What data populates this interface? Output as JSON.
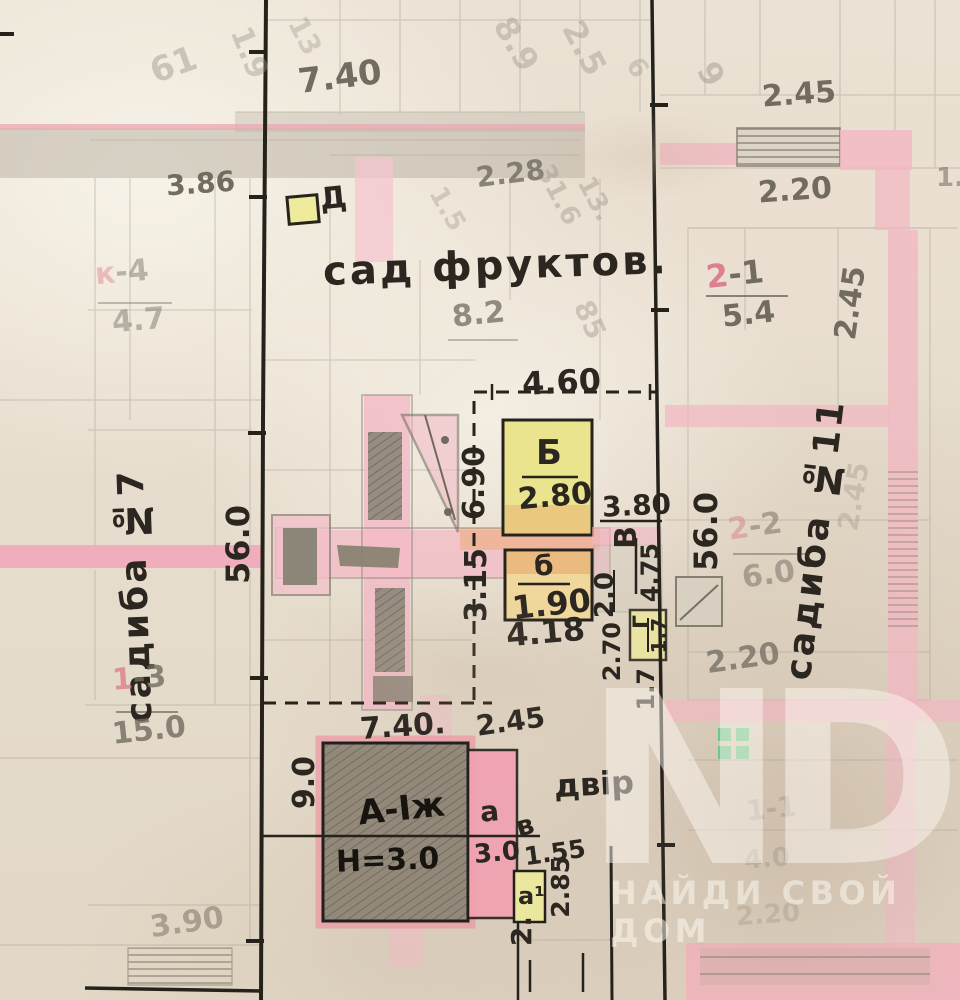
{
  "labels": {
    "orchard": "сад фруктов.",
    "yard": "двір",
    "marker_d": "Д",
    "estate_left": "садиба №7",
    "estate_right": "садиба №11",
    "frontage_left": "56.0",
    "frontage_right": "56.0",
    "bldg_b_letter": "Б",
    "bldg_b_area": "2.80",
    "bldg_b2_letter": "б",
    "bldg_b2_area": "1.90",
    "bldg_v_letter": "В",
    "bldg_v_area": "4.75",
    "bldg_g_letter": "Г",
    "bldg_g_area": "1.7",
    "bldg_a_letter": "А-Іж",
    "bldg_a_height": "Н=3.0",
    "annex_a_letter": "а",
    "annex_a_area": "3.0",
    "annex_a1_letter": "а¹",
    "letter_v_small": "в",
    "apt21_num": "2",
    "apt21_idx": "-1",
    "apt21_area": "5.4",
    "apt22_num": "2",
    "apt22_idx": "-2",
    "apt22_area": "6.0",
    "apt13_num": "1",
    "apt13_idx": "-3",
    "apt13_area": "15.0",
    "aptk4_num": "к",
    "aptk4_idx": "-4",
    "aptk4_area": "4.7",
    "dim_740_top": "7.40",
    "dim_386": "3.86",
    "dim_228": "2.28",
    "dim_82": "8.2",
    "dim_460": "4.60",
    "dim_690": "6.90",
    "dim_315": "3.15",
    "dim_380": "3.80",
    "dim_20": "2.0",
    "dim_418": "4.18",
    "dim_270": "2.70",
    "dim_17": "1.7",
    "dim_740_bottom": "7.40.",
    "dim_245_bottom": "2.45",
    "dim_90": "9.0",
    "dim_155": "1.55",
    "dim_285": "2.85",
    "dim_2dot": "2.",
    "dim_390": "3.90",
    "dim_245_topright": "2.45",
    "dim_220_topright": "2.20",
    "dim_245_right": "2.45",
    "dim_220_right": "2.20",
    "dim_245_right2": "2.45",
    "faint_61": "61",
    "faint_19": "1.9",
    "faint_13": "13",
    "faint_89": "8.9",
    "faint_25": "2.5",
    "faint_6": "6",
    "faint_9": "9",
    "faint_15": "1.5",
    "faint_316": "31.6",
    "faint_13b": "13.",
    "faint_85": "85",
    "faint_1": "1.",
    "faint_11": "1-1",
    "faint_40": "4.0",
    "faint_220b": "2.20"
  },
  "watermark": {
    "monogram": "ND",
    "tagline": "НАЙДИ СВОЙ ДОМ"
  },
  "colors": {
    "pink_wall": "#f2b6c2",
    "pink_street": "#f1a5b7",
    "yellow_bldg": "#e9e48d",
    "grey_bldg": "#8e8577",
    "ink": "#2b2620",
    "pencil": "#716b60",
    "green_mark": "#66c485"
  }
}
